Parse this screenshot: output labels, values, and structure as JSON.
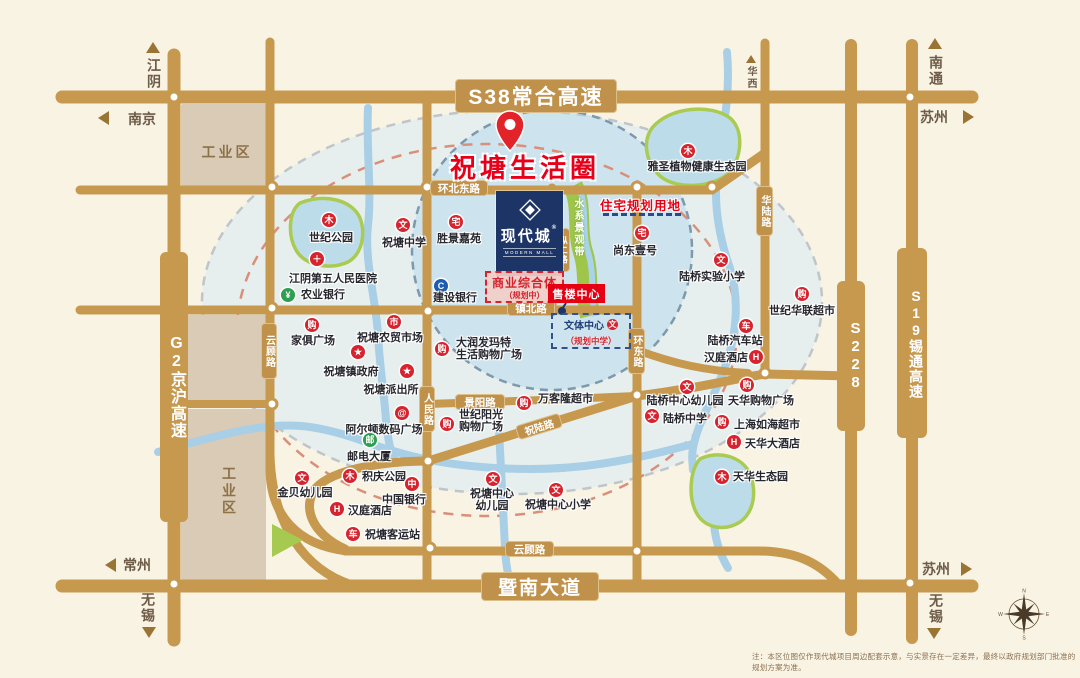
{
  "note": {
    "disclaimer": "注：本区位图仅作现代城项目周边配套示意，与实景存在一定差异，最终以政府规划部门批准的规划方案为准。"
  },
  "project": {
    "pin_title": "祝塘生活圈",
    "name": "现代城",
    "trademark": "®",
    "name_en": "MODERN MALL",
    "sales_center": "售楼中心",
    "commercial_complex": "商业综合体",
    "commercial_note": "（规划中）",
    "residential_planning": "住宅规划用地",
    "culture_center": "文体中心",
    "culture_note": "（规划中学）",
    "culture_icon_glyph": "文",
    "water_belt": "水系景观带"
  },
  "roads": {
    "s38": "S38常合高速",
    "g2": "G2京沪高速",
    "s19": "S19锡通高速",
    "s228": "S228",
    "huanbeidong": "环北东路",
    "zhenbei": "镇北路",
    "zonger": "纵二路",
    "renmin": "人民路",
    "huandong": "环东路",
    "hualu": "华陆路",
    "jingyang": "景阳路",
    "zhulu": "祝陆路",
    "yungu_vertical": "云顾路",
    "yungu_bottom": "云顾路",
    "jinan": "暨南大道"
  },
  "directions": {
    "jiangyin": "江阴",
    "nanjing": "南京",
    "huaxi": "华西",
    "nantong": "南通",
    "suzhou_ne": "苏州",
    "changzhou": "常州",
    "wuxi_sw": "无锡",
    "suzhou_se": "苏州",
    "wuxi_se": "无锡"
  },
  "zones": {
    "industrial_nw": "工业区",
    "industrial_sw": "工业区"
  },
  "compass": {
    "n": "N",
    "e": "E",
    "s": "S",
    "w": "W"
  },
  "pois": [
    {
      "label": "世纪公园",
      "glyph": "木",
      "icon": "park-icon"
    },
    {
      "label": "祝塘中学",
      "glyph": "文",
      "icon": "school-icon"
    },
    {
      "label": "胜景嘉苑",
      "glyph": "宅",
      "icon": "residence-icon"
    },
    {
      "label": "江阴第五人民医院",
      "glyph": "＋",
      "icon": "hospital-icon"
    },
    {
      "label": "农业银行",
      "glyph": "¥",
      "icon": "bank-icon"
    },
    {
      "label": "建设银行",
      "glyph": "C",
      "icon": "bank-icon"
    },
    {
      "label": "家俱广场",
      "glyph": "购",
      "icon": "shopping-icon"
    },
    {
      "label": "祝塘农贸市场",
      "glyph": "市",
      "icon": "market-icon"
    },
    {
      "label": "祝塘镇政府",
      "glyph": "★",
      "icon": "government-icon"
    },
    {
      "label": "祝塘派出所",
      "glyph": "★",
      "icon": "police-icon"
    },
    {
      "label": "大润发玛特",
      "label2": "生活购物广场",
      "glyph": "购",
      "icon": "shopping-icon"
    },
    {
      "label": "万客隆超市",
      "glyph": "购",
      "icon": "shopping-icon"
    },
    {
      "label": "世纪阳光",
      "label2": "购物广场",
      "glyph": "购",
      "icon": "shopping-icon"
    },
    {
      "label": "阿尔顿数码广场",
      "glyph": "@",
      "icon": "digital-plaza-icon"
    },
    {
      "label": "邮电大厦",
      "glyph": "邮",
      "icon": "post-icon"
    },
    {
      "label": "积庆公园",
      "glyph": "木",
      "icon": "park-icon"
    },
    {
      "label": "中国银行",
      "glyph": "中",
      "icon": "bank-icon"
    },
    {
      "label": "金贝幼儿园",
      "glyph": "文",
      "icon": "kindergarten-icon"
    },
    {
      "label": "汉庭酒店",
      "glyph": "H",
      "icon": "hotel-icon"
    },
    {
      "label": "祝塘客运站",
      "glyph": "车",
      "icon": "bus-station-icon"
    },
    {
      "label": "祝塘中心",
      "label2": "幼儿园",
      "glyph": "文",
      "icon": "kindergarten-icon"
    },
    {
      "label": "祝塘中心小学",
      "glyph": "文",
      "icon": "school-icon"
    },
    {
      "label": "尚东壹号",
      "glyph": "宅",
      "icon": "residence-icon"
    },
    {
      "label": "雅圣植物健康生态园",
      "glyph": "木",
      "icon": "park-icon"
    },
    {
      "label": "陆桥实验小学",
      "glyph": "文",
      "icon": "school-icon"
    },
    {
      "label": "世纪华联超市",
      "glyph": "购",
      "icon": "shopping-icon"
    },
    {
      "label": "陆桥汽车站",
      "glyph": "车",
      "icon": "bus-station-icon"
    },
    {
      "label": "汉庭酒店",
      "glyph": "H",
      "icon": "hotel-icon"
    },
    {
      "label": "陆桥中心幼儿园",
      "glyph": "文",
      "icon": "kindergarten-icon"
    },
    {
      "label": "天华购物广场",
      "glyph": "购",
      "icon": "shopping-icon"
    },
    {
      "label": "陆桥中学",
      "glyph": "文",
      "icon": "school-icon"
    },
    {
      "label": "上海如海超市",
      "glyph": "购",
      "icon": "shopping-icon"
    },
    {
      "label": "天华大酒店",
      "glyph": "H",
      "icon": "hotel-icon"
    },
    {
      "label": "天华生态园",
      "glyph": "木",
      "icon": "park-icon"
    }
  ]
}
